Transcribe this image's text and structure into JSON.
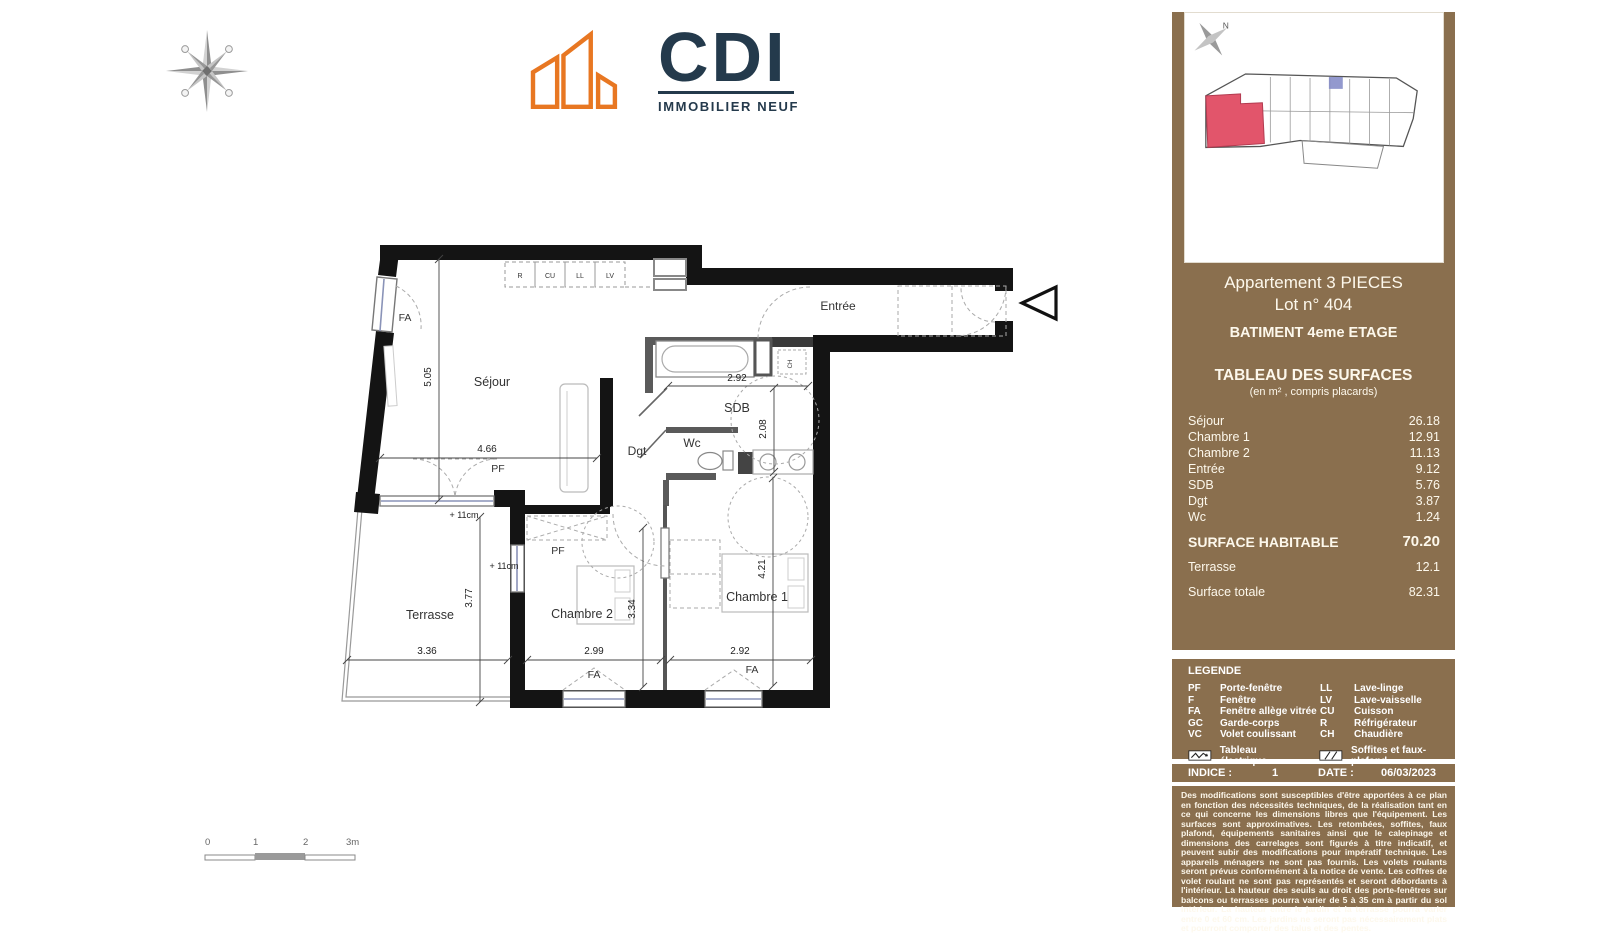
{
  "logo": {
    "text": "CDI",
    "subtitle": "IMMOBILIER NEUF",
    "orange": "#E87722",
    "navy": "#243A4C"
  },
  "sidebar": {
    "apartment_title": "Appartement 3 PIECES",
    "lot": "Lot n° 404",
    "building": "BATIMENT 4eme ETAGE",
    "table_title": "TABLEAU DES SURFACES",
    "table_subtitle": "(en m² , compris placards)",
    "rows": [
      {
        "label": "Séjour",
        "value": "26.18"
      },
      {
        "label": "Chambre 1",
        "value": "12.91"
      },
      {
        "label": "Chambre 2",
        "value": "11.13"
      },
      {
        "label": "Entrée",
        "value": "9.12"
      },
      {
        "label": "SDB",
        "value": "5.76"
      },
      {
        "label": "Dgt",
        "value": "3.87"
      },
      {
        "label": "Wc",
        "value": "1.24"
      }
    ],
    "habitable": {
      "label": "SURFACE HABITABLE",
      "value": "70.20"
    },
    "terrasse": {
      "label": "Terrasse",
      "value": "12.1"
    },
    "totale": {
      "label": "Surface totale",
      "value": "82.31"
    },
    "legend": {
      "title": "LEGENDE",
      "left": [
        {
          "abbr": "PF",
          "label": "Porte-fenêtre"
        },
        {
          "abbr": "F",
          "label": "Fenêtre"
        },
        {
          "abbr": "FA",
          "label": "Fenêtre allège vitrée"
        },
        {
          "abbr": "GC",
          "label": "Garde-corps"
        },
        {
          "abbr": "VC",
          "label": "Volet coulissant"
        }
      ],
      "right": [
        {
          "abbr": "LL",
          "label": "Lave-linge"
        },
        {
          "abbr": "LV",
          "label": "Lave-vaisselle"
        },
        {
          "abbr": "CU",
          "label": "Cuisson"
        },
        {
          "abbr": "R",
          "label": "Réfrigérateur"
        },
        {
          "abbr": "CH",
          "label": "Chaudière"
        }
      ],
      "electrical": "Tableau électrique",
      "soffits": "Soffites et faux-plafond"
    },
    "indice_label": "INDICE :",
    "indice_value": "1",
    "date_label": "DATE :",
    "date_value": "06/03/2023",
    "map_north": "N",
    "colors": {
      "panel": "#8A6F4E",
      "highlight": "#E2556B",
      "stair_mark": "#8087C6"
    },
    "disclaimer": "Des modifications sont susceptibles d'être apportées à ce plan en fonction des nécessités techniques, de la réalisation tant en ce qui concerne les dimensions libres que l'équipement. Les surfaces sont approximatives. Les retombées, soffites, faux plafond, équipements sanitaires ainsi que le calepinage et dimensions des carrelages sont figurés à titre indicatif, et peuvent subir des modifications pour impératif technique. Les appareils ménagers ne sont pas fournis. Les volets roulants seront prévus conformément à la notice de vente. Les coffres de volet roulant ne sont pas représentés et seront débordants à l'intérieur. La hauteur des seuils au droit des porte-fenêtres sur balcons ou terrasses pourra varier de 5 à 35 cm à partir du sol intérieur. La hauteur entre le jardin et la terrasse pourra varier entre 0 et 60 cm. Les jardins ne seront pas nécessairement plats et pourront comporter des talus et des pentes."
  },
  "plan": {
    "rooms": {
      "sejour": "Séjour",
      "entree": "Entrée",
      "sdb": "SDB",
      "wc": "Wc",
      "dgt": "Dgt",
      "ch1": "Chambre 1",
      "ch2": "Chambre 2",
      "terrasse": "Terrasse"
    },
    "dims": {
      "sejour_w": "4.66",
      "sejour_h": "5.05",
      "sdb_w": "2.92",
      "sdb_h": "2.08",
      "terr_w": "3.36",
      "terr_h": "3.77",
      "ch2_w": "2.99",
      "ch2_h": "3.34",
      "ch1_w": "2.92",
      "ch1_h": "4.21"
    },
    "steps": {
      "a": "+ 11cm",
      "b": "+ 11cm"
    },
    "tags": {
      "fa": "FA",
      "pf": "PF",
      "ch": "CH"
    },
    "appliances": {
      "r": "R",
      "cu": "CU",
      "ll": "LL",
      "lv": "LV"
    },
    "scale": {
      "t0": "0",
      "t1": "1",
      "t2": "2",
      "t3": "3m"
    }
  }
}
